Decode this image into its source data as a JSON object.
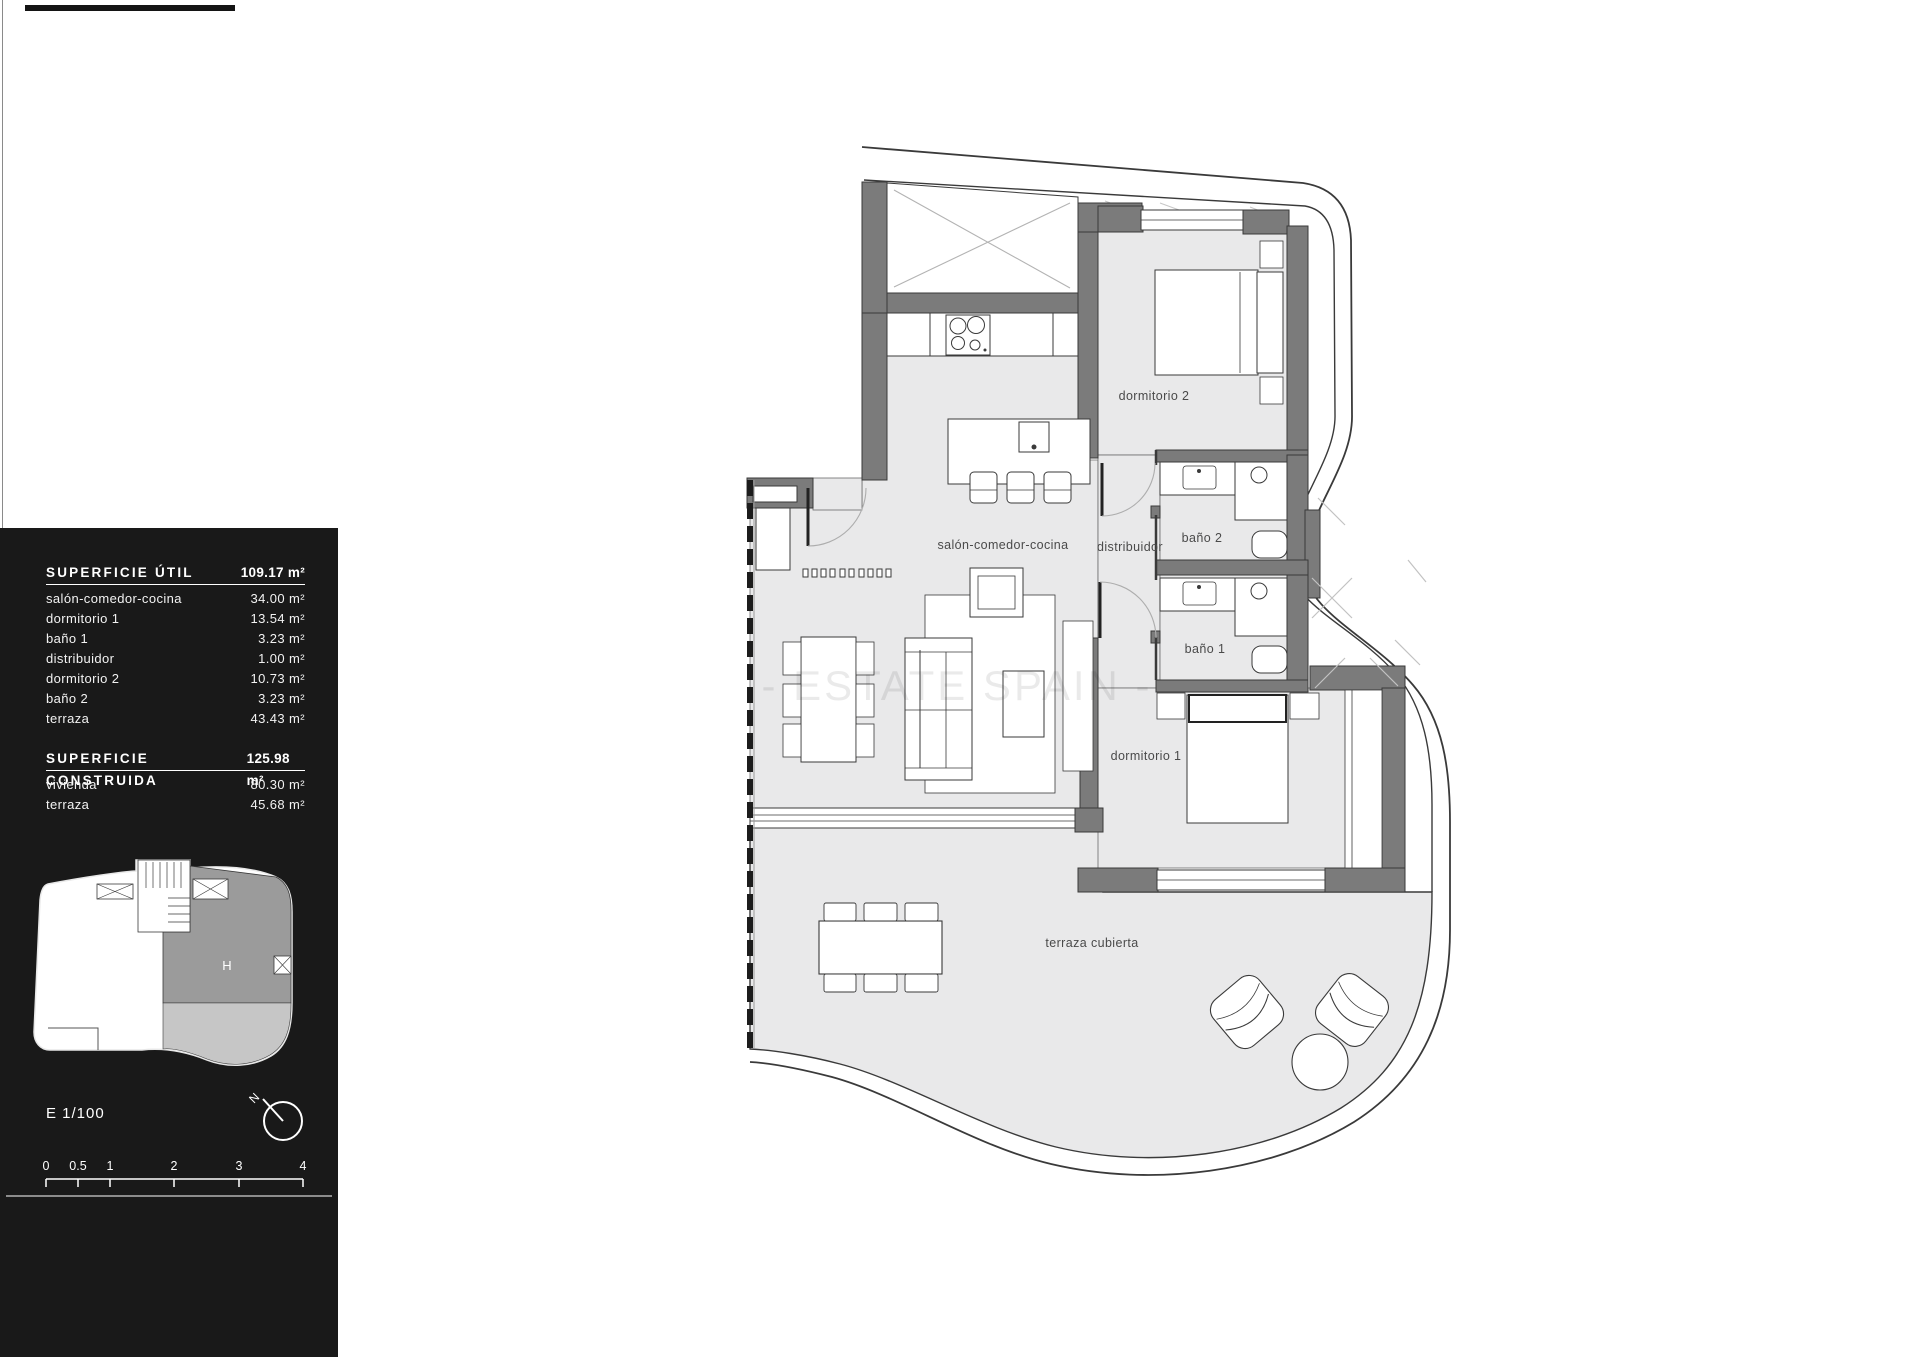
{
  "panel": {
    "tables": [
      {
        "title": "SUPERFICIE ÚTIL",
        "total": "109.17 m²",
        "rows": [
          {
            "label": "salón-comedor-cocina",
            "value": "34.00 m²"
          },
          {
            "label": "dormitorio 1",
            "value": "13.54 m²"
          },
          {
            "label": "baño 1",
            "value": "3.23 m²"
          },
          {
            "label": "distribuidor",
            "value": "1.00 m²"
          },
          {
            "label": "dormitorio 2",
            "value": "10.73 m²"
          },
          {
            "label": "baño 2",
            "value": "3.23 m²"
          },
          {
            "label": "terraza",
            "value": "43.43 m²"
          }
        ]
      },
      {
        "title": "SUPERFICIE CONSTRUIDA",
        "total": "125.98 m²",
        "rows": [
          {
            "label": "vivienda",
            "value": "80.30 m²"
          },
          {
            "label": "terraza",
            "value": "45.68 m²"
          }
        ]
      }
    ],
    "key_plan": {
      "unit_label": "H"
    },
    "scale_label": "E 1/100",
    "north_label": "N",
    "scale_ticks": [
      "0",
      "0.5",
      "1",
      "2",
      "3",
      "4"
    ]
  },
  "plan": {
    "watermark": "- ESTATE SPAIN -",
    "labels": {
      "dormitorio2": "dormitorio 2",
      "salon": "salón-comedor-cocina",
      "distribuidor": "distribuidor",
      "bano2": "baño 2",
      "bano1": "baño 1",
      "dormitorio1": "dormitorio 1",
      "terraza": "terraza cubierta"
    }
  },
  "colors": {
    "wall": "#7b7b7b",
    "floor": "#e9e9ea",
    "line": "#3a3a3a",
    "panel_bg": "#191919",
    "keyplan_unit": "#9b9b9b",
    "keyplan_terrace": "#c6c6c6"
  }
}
